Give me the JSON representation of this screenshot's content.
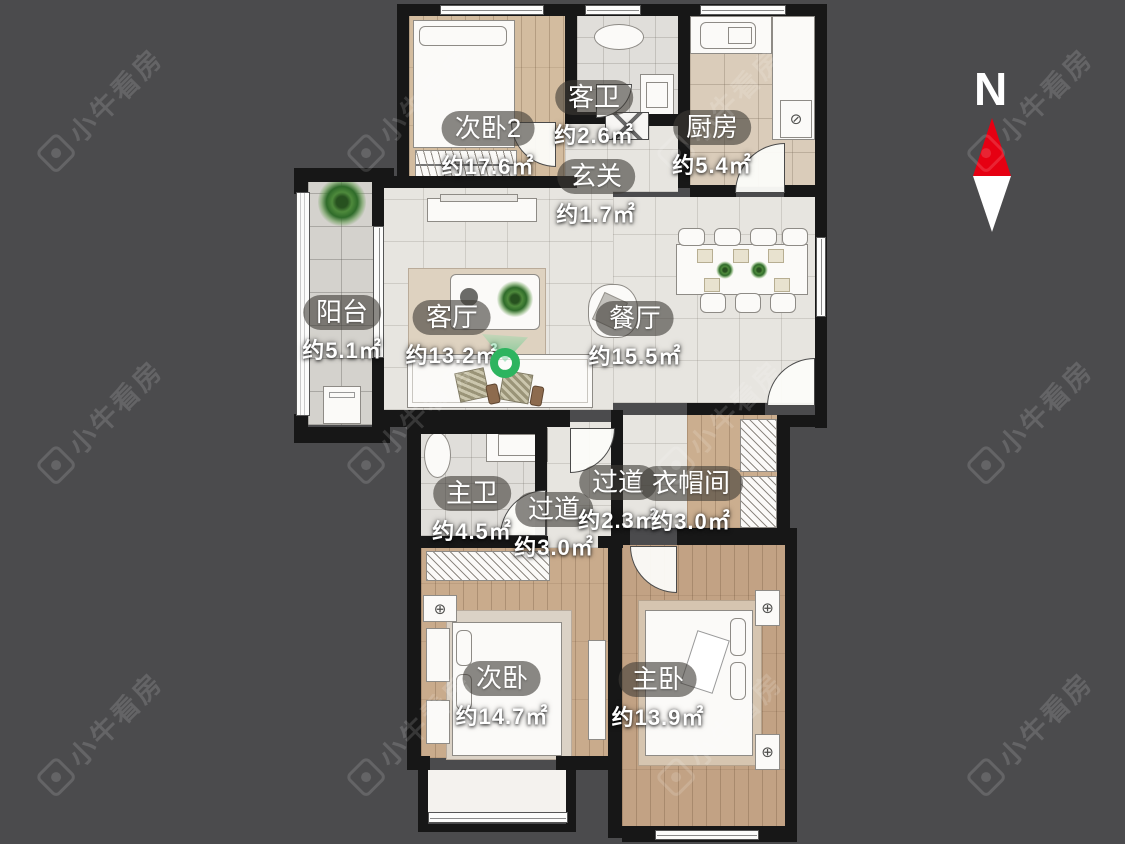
{
  "watermark": {
    "text": "小牛看房",
    "logo_icon": "niu-camera-logo-icon"
  },
  "compass": {
    "north_label": "N",
    "needle_north_color": "#e60012",
    "needle_south_color": "#ffffff"
  },
  "pin": {
    "icon": "location-pin-icon",
    "color": "#2db45f"
  },
  "palette": {
    "background": "#4b4b4d",
    "wall": "#171717",
    "marble_floor": "#e7e5e0",
    "wood_floor": "#c7a98a",
    "label_pill": "rgba(62,58,54,0.6)",
    "label_text": "#ffffff"
  },
  "rooms": [
    {
      "id": "bedroom2",
      "name": "次卧2",
      "area": "约17.6㎡"
    },
    {
      "id": "guest-bath",
      "name": "客卫",
      "area": "约2.6㎡"
    },
    {
      "id": "kitchen",
      "name": "厨房",
      "area": "约5.4㎡"
    },
    {
      "id": "entry",
      "name": "玄关",
      "area": "约1.7㎡"
    },
    {
      "id": "balcony",
      "name": "阳台",
      "area": "约5.1㎡"
    },
    {
      "id": "living-room",
      "name": "客厅",
      "area": "约13.2㎡"
    },
    {
      "id": "dining-room",
      "name": "餐厅",
      "area": "约15.5㎡"
    },
    {
      "id": "master-bath",
      "name": "主卫",
      "area": "约4.5㎡"
    },
    {
      "id": "hallway-lower",
      "name": "过道",
      "area": "约3.0㎡"
    },
    {
      "id": "hallway-upper",
      "name": "过道",
      "area": "约2.3㎡"
    },
    {
      "id": "cloakroom",
      "name": "衣帽间",
      "area": "约3.0㎡"
    },
    {
      "id": "second-bedroom",
      "name": "次卧",
      "area": "约14.7㎡"
    },
    {
      "id": "master-bedroom",
      "name": "主卧",
      "area": "约13.9㎡"
    }
  ]
}
